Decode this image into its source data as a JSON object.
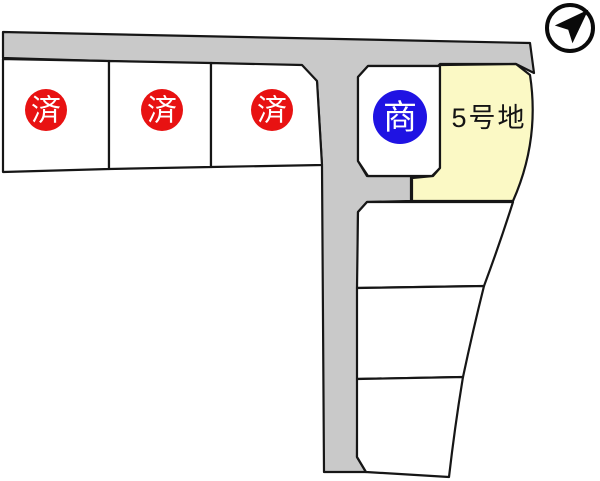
{
  "colors": {
    "road": "#c9c9c9",
    "lot_fill": "#ffffff",
    "outline": "#161616",
    "highlight": "#fbf9c5",
    "sold_badge": "#e81212",
    "negotiating_badge": "#1f13e3",
    "badge_text": "#ffffff"
  },
  "badges": [
    {
      "lot": "lot-1",
      "label": "済",
      "status": "sold",
      "color": "#e81212"
    },
    {
      "lot": "lot-2",
      "label": "済",
      "status": "sold",
      "color": "#e81212"
    },
    {
      "lot": "lot-3",
      "label": "済",
      "status": "sold",
      "color": "#e81212"
    },
    {
      "lot": "lot-4",
      "label": "商",
      "status": "negotiating",
      "color": "#1f13e3"
    }
  ],
  "labels": [
    {
      "lot": "lot-5",
      "text": "5号地"
    }
  ],
  "compass": {
    "icon": "north-arrow"
  }
}
